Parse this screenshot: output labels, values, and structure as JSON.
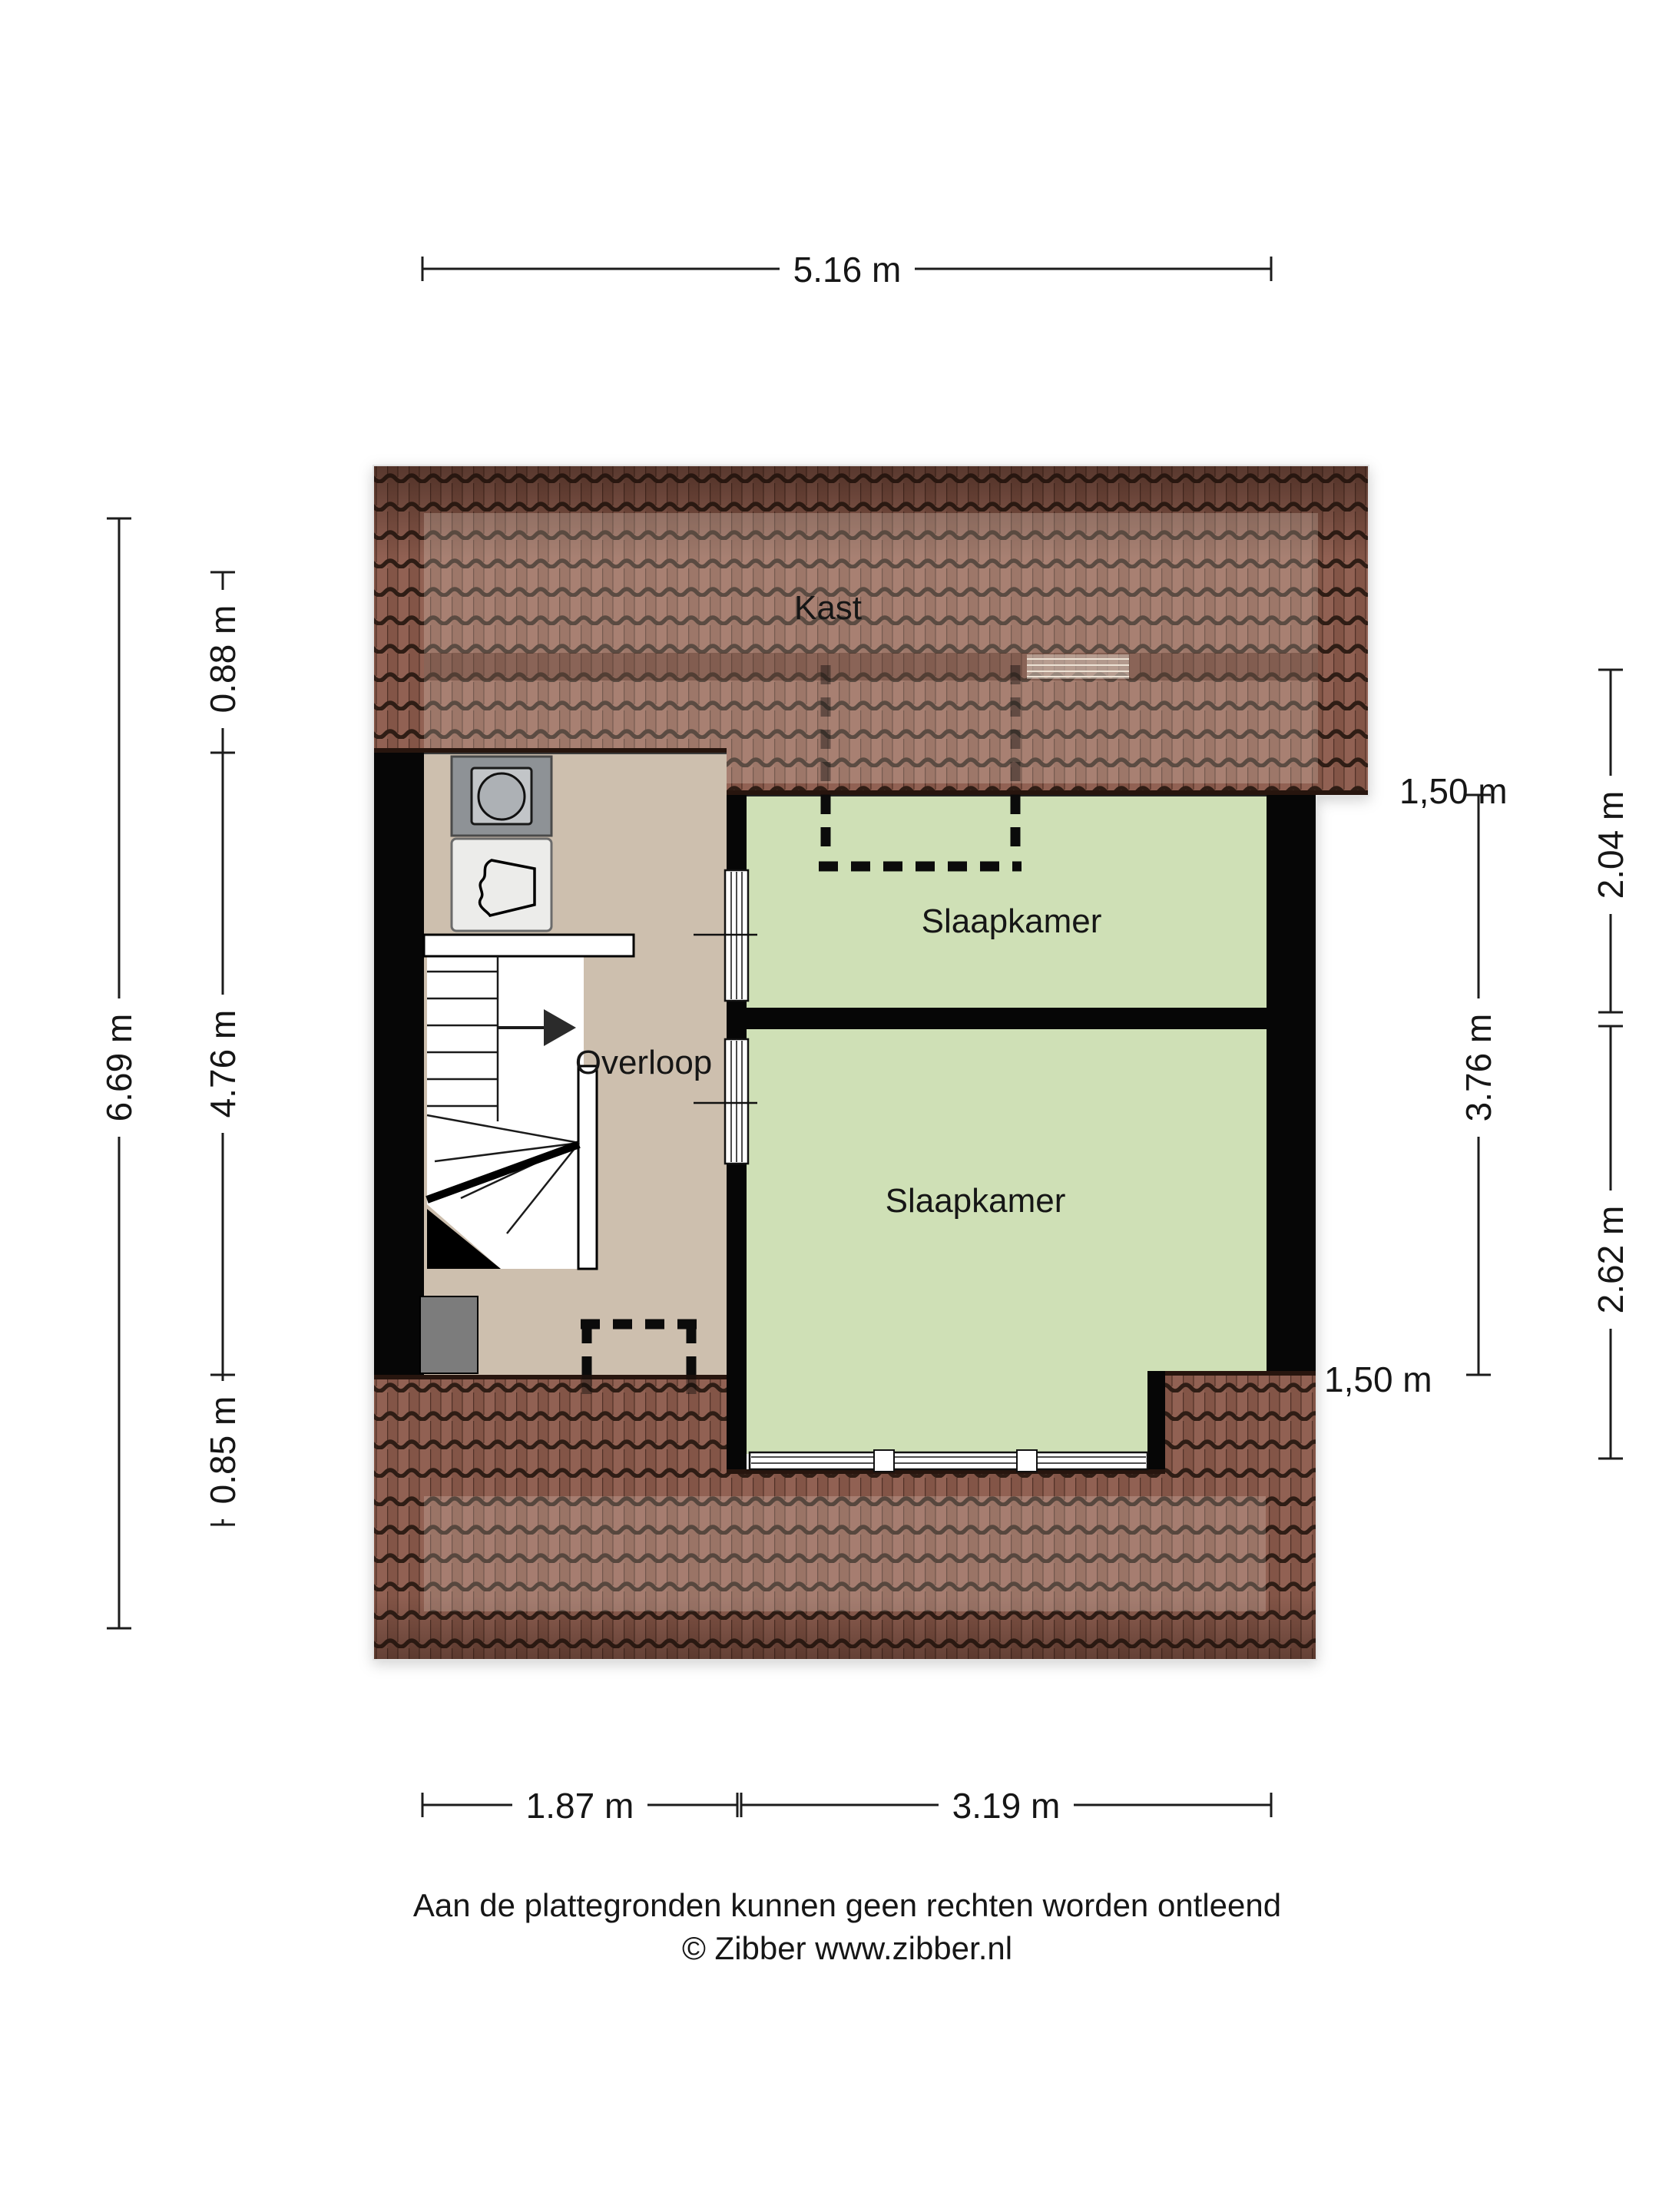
{
  "dimensions": {
    "top_width": "5.16 m",
    "left_total": "6.69 m",
    "left_segments": [
      "0.88 m",
      "4.76 m",
      "0.85 m"
    ],
    "right_inner": "3.76 m",
    "right_segments": [
      "2.04 m",
      "2.62 m"
    ],
    "headroom_labels": [
      "1,50 m",
      "1,50 m"
    ],
    "bottom_segments": [
      "1.87 m",
      "3.19 m"
    ]
  },
  "rooms": {
    "closet": "Kast",
    "bedroom_top": "Slaapkamer",
    "bedroom_bottom": "Slaapkamer",
    "landing": "Overloop"
  },
  "footer": {
    "disclaimer": "Aan de plattegronden kunnen geen rechten worden ontleend",
    "credit": "© Zibber www.zibber.nl"
  },
  "colors": {
    "room_green": "#cfe0b6",
    "floor_beige": "#cdbfae",
    "roof_brown": "#8d5b4c",
    "wall_black": "#060606"
  }
}
